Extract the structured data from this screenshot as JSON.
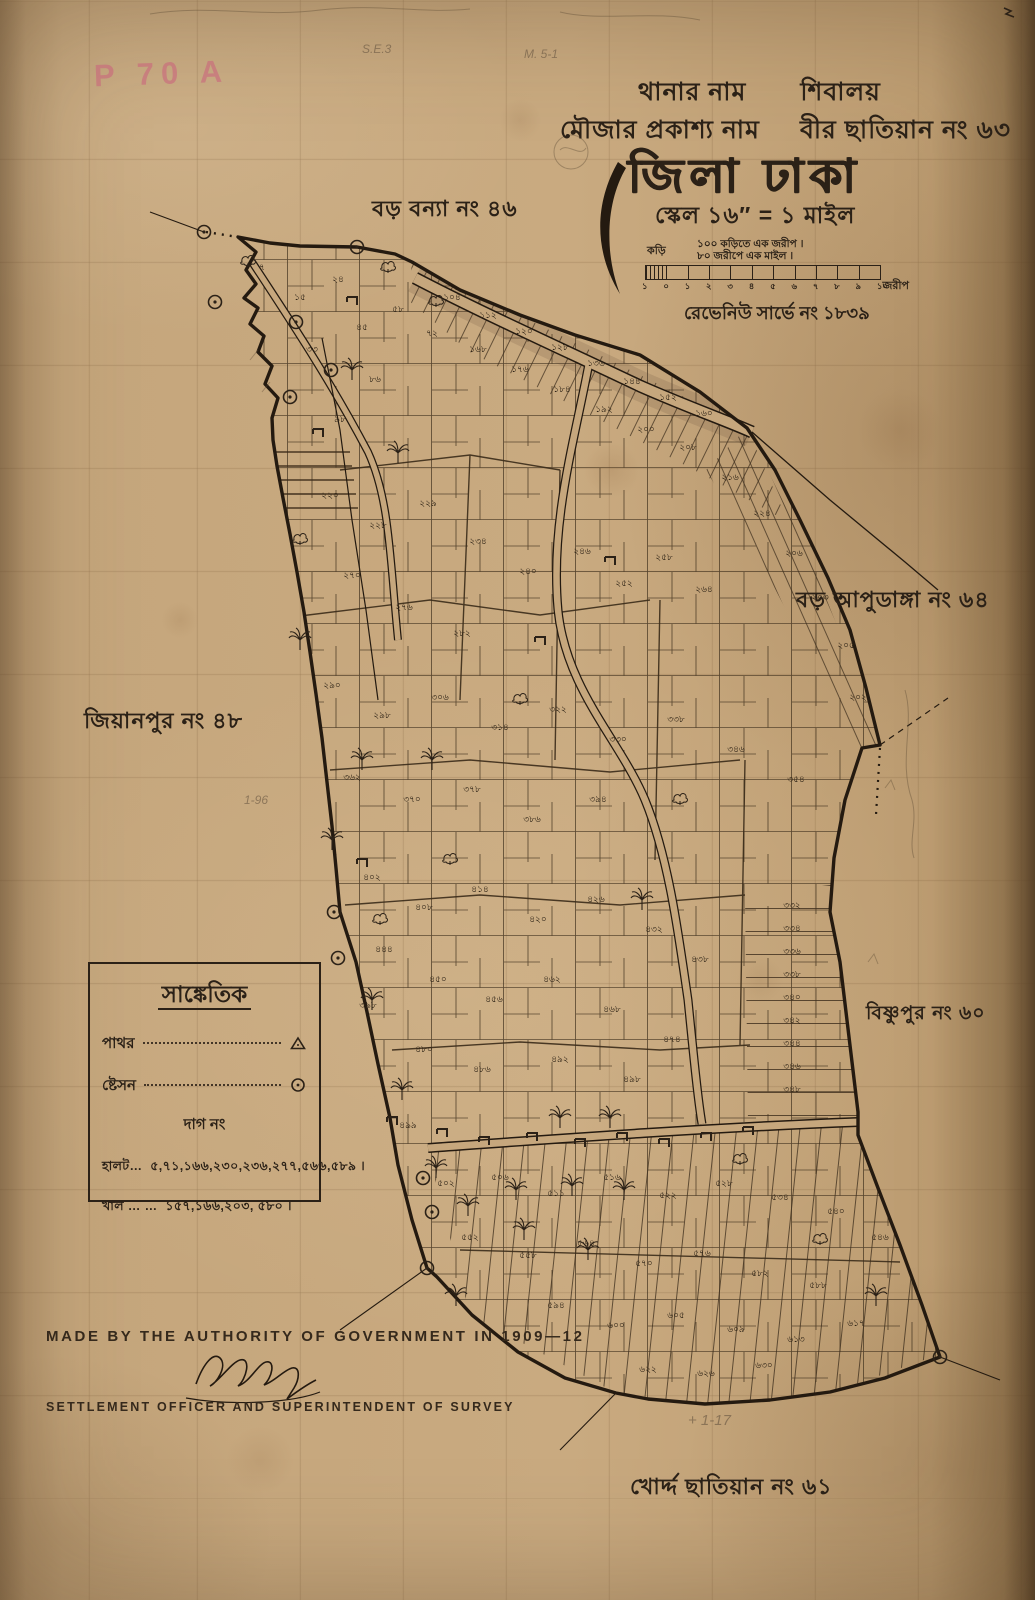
{
  "stamp": "P 70 A",
  "pencil": {
    "note1": "S.E.3",
    "note2": "M. 5-1",
    "note3": "+ 1-17",
    "note4": "1-96"
  },
  "header": {
    "thana_label": "থানার নাম",
    "thana_value": "শিবালয়",
    "mouza_label": "মৌজার প্রকাশ্য নাম",
    "mouza_value": "বীর ছাতিয়ান নং ৬৩",
    "district_title": "জিলা ঢাকা",
    "scale_line": "স্কেল ১৬″ = ১ মাইল",
    "scale_unit_left": "কড়ি",
    "scale_note_1": "১০০ কড়িতে এক জরীপ ।",
    "scale_note_2": "৮০ জরীপে এক মাইল ।",
    "scale_ticks": [
      "১",
      "০",
      "১",
      "২",
      "৩",
      "৪",
      "৫",
      "৬",
      "৭",
      "৮",
      "৯",
      "১০"
    ],
    "scale_unit_right": "জরীপ",
    "revenue_line": "রেভেনিউ সার্ভে নং ১৮৩৯"
  },
  "neighbors": [
    {
      "name": "বড় বন্যা নং ৪৬"
    },
    {
      "name": "বড় আপুডাঙ্গা নং ৬৪"
    },
    {
      "name": "জিয়ানপুর নং ৪৮"
    },
    {
      "name": "বিষ্ণুপুর নং ৬০"
    },
    {
      "name": "খোর্দ্দ ছাতিয়ান নং ৬১"
    }
  ],
  "legend": {
    "title": "সাঙ্কেতিক",
    "row_stone": "পাথর",
    "row_station": "ষ্টেসন",
    "dag_heading": "দাগ নং",
    "halot_label": "হালট…",
    "halot_numbers": "৫,৭১,১৬৬,২৩০,২৩৬,২৭৭,৫৬৬,৫৮৯ ।",
    "khal_label": "খাল … …",
    "khal_numbers": "১৫৭,১৬৬,২০৩, ৫৮০ ।"
  },
  "footer": {
    "authority_line": "MADE BY THE AUTHORITY OF GOVERNMENT IN 1909—12",
    "officer_line": "SETTLEMENT OFFICER AND SUPERINTENDENT OF SURVEY"
  },
  "map": {
    "plot_numbers": [
      [
        262,
        270,
        "৭"
      ],
      [
        300,
        300,
        "১৫"
      ],
      [
        338,
        282,
        "২৪"
      ],
      [
        312,
        352,
        "৩৩"
      ],
      [
        362,
        330,
        "৪৫"
      ],
      [
        398,
        312,
        "৫৮"
      ],
      [
        432,
        336,
        "৭২"
      ],
      [
        375,
        382,
        "৮৬"
      ],
      [
        340,
        422,
        "৯৮"
      ],
      [
        452,
        300,
        "১০৪"
      ],
      [
        488,
        318,
        "১১২"
      ],
      [
        524,
        334,
        "১২০"
      ],
      [
        560,
        350,
        "১২৮"
      ],
      [
        596,
        366,
        "১৩৬"
      ],
      [
        632,
        384,
        "১৪৪"
      ],
      [
        668,
        400,
        "১৫২"
      ],
      [
        704,
        416,
        "১৬০"
      ],
      [
        478,
        352,
        "১৬৮"
      ],
      [
        520,
        372,
        "১৭৬"
      ],
      [
        562,
        392,
        "১৮৪"
      ],
      [
        604,
        412,
        "১৯২"
      ],
      [
        646,
        432,
        "২০০"
      ],
      [
        688,
        450,
        "২০৮"
      ],
      [
        730,
        480,
        "২১৬"
      ],
      [
        762,
        516,
        "২২৪"
      ],
      [
        794,
        556,
        "২০৬"
      ],
      [
        820,
        600,
        "২০৩"
      ],
      [
        846,
        648,
        "২০৫"
      ],
      [
        858,
        700,
        "২০২"
      ],
      [
        330,
        498,
        "২২০"
      ],
      [
        378,
        528,
        "২২৮"
      ],
      [
        428,
        506,
        "২২৯"
      ],
      [
        478,
        544,
        "২৩৪"
      ],
      [
        528,
        574,
        "২৪০"
      ],
      [
        582,
        554,
        "২৪৬"
      ],
      [
        624,
        586,
        "২৫২"
      ],
      [
        664,
        560,
        "২৫৮"
      ],
      [
        704,
        592,
        "২৬৪"
      ],
      [
        352,
        578,
        "২৭০"
      ],
      [
        404,
        610,
        "২৭৬"
      ],
      [
        462,
        636,
        "২৮২"
      ],
      [
        332,
        688,
        "২৯০"
      ],
      [
        382,
        718,
        "২৯৮"
      ],
      [
        440,
        700,
        "৩০৬"
      ],
      [
        500,
        730,
        "৩১৪"
      ],
      [
        558,
        712,
        "৩২২"
      ],
      [
        618,
        742,
        "৩৩০"
      ],
      [
        676,
        722,
        "৩৩৮"
      ],
      [
        736,
        752,
        "৩৪৬"
      ],
      [
        796,
        782,
        "৩৫৪"
      ],
      [
        352,
        780,
        "৩৬২"
      ],
      [
        412,
        802,
        "৩৭০"
      ],
      [
        472,
        792,
        "৩৭৮"
      ],
      [
        532,
        822,
        "৩৮৬"
      ],
      [
        598,
        802,
        "৩৯৪"
      ],
      [
        792,
        908,
        "৩৩২"
      ],
      [
        792,
        931,
        "৩৩৪"
      ],
      [
        792,
        954,
        "৩৩৬"
      ],
      [
        792,
        977,
        "৩৩৮"
      ],
      [
        792,
        1000,
        "৩৪০"
      ],
      [
        792,
        1023,
        "৩৪২"
      ],
      [
        792,
        1046,
        "৩৪৪"
      ],
      [
        792,
        1069,
        "৩৪৬"
      ],
      [
        792,
        1092,
        "৩৪৮"
      ],
      [
        372,
        880,
        "৪০২"
      ],
      [
        424,
        910,
        "৪০৮"
      ],
      [
        480,
        892,
        "৪১৪"
      ],
      [
        538,
        922,
        "৪২০"
      ],
      [
        596,
        902,
        "৪২৬"
      ],
      [
        654,
        932,
        "৪৩২"
      ],
      [
        700,
        962,
        "৪৩৮"
      ],
      [
        384,
        952,
        "৪৪৪"
      ],
      [
        438,
        982,
        "৪৫০"
      ],
      [
        494,
        1002,
        "৪৫৬"
      ],
      [
        552,
        982,
        "৪৬২"
      ],
      [
        612,
        1012,
        "৪৬৮"
      ],
      [
        368,
        1008,
        "৩৯৮"
      ],
      [
        672,
        1042,
        "৪৭৪"
      ],
      [
        424,
        1052,
        "৪৮০"
      ],
      [
        482,
        1072,
        "৪৮৬"
      ],
      [
        560,
        1062,
        "৪৯২"
      ],
      [
        632,
        1082,
        "৪৯৮"
      ],
      [
        408,
        1128,
        "৪৯৯"
      ],
      [
        446,
        1186,
        "৫০২"
      ],
      [
        500,
        1180,
        "৫০৬"
      ],
      [
        556,
        1196,
        "৫১১"
      ],
      [
        612,
        1180,
        "৫১৬"
      ],
      [
        668,
        1198,
        "৫২২"
      ],
      [
        724,
        1186,
        "৫২৮"
      ],
      [
        780,
        1200,
        "৫৩৪"
      ],
      [
        836,
        1214,
        "৫৪০"
      ],
      [
        880,
        1240,
        "৫৪৬"
      ],
      [
        470,
        1240,
        "৫৫২"
      ],
      [
        528,
        1258,
        "৫৫৮"
      ],
      [
        586,
        1246,
        "৫৬৪"
      ],
      [
        644,
        1266,
        "৫৭০"
      ],
      [
        702,
        1256,
        "৫৭৬"
      ],
      [
        760,
        1276,
        "৫৮২"
      ],
      [
        818,
        1288,
        "৫৮৮"
      ],
      [
        556,
        1308,
        "৫৯৪"
      ],
      [
        616,
        1328,
        "৬০০"
      ],
      [
        676,
        1318,
        "৬০৫"
      ],
      [
        736,
        1332,
        "৬০৯"
      ],
      [
        796,
        1342,
        "৬১৩"
      ],
      [
        856,
        1326,
        "৬১৭"
      ],
      [
        648,
        1372,
        "৬২২"
      ],
      [
        706,
        1376,
        "৬২৬"
      ],
      [
        764,
        1368,
        "৬৩০"
      ]
    ],
    "stations": [
      [
        204,
        232
      ],
      [
        357,
        247
      ],
      [
        215,
        302
      ],
      [
        296,
        322
      ],
      [
        331,
        370
      ],
      [
        290,
        397
      ],
      [
        334,
        912
      ],
      [
        338,
        958
      ],
      [
        423,
        1178
      ],
      [
        432,
        1212
      ],
      [
        427,
        1268
      ],
      [
        940,
        1357
      ]
    ],
    "trees": [
      [
        352,
        372,
        "p"
      ],
      [
        398,
        455,
        "p"
      ],
      [
        300,
        642,
        "p"
      ],
      [
        362,
        762,
        "p"
      ],
      [
        332,
        842,
        "p"
      ],
      [
        372,
        1002,
        "p"
      ],
      [
        402,
        1092,
        "p"
      ],
      [
        436,
        1170,
        "p"
      ],
      [
        468,
        1208,
        "p"
      ],
      [
        516,
        1192,
        "p"
      ],
      [
        572,
        1188,
        "p"
      ],
      [
        624,
        1192,
        "p"
      ],
      [
        524,
        1232,
        "p"
      ],
      [
        588,
        1252,
        "p"
      ],
      [
        456,
        1298,
        "p"
      ],
      [
        876,
        1298,
        "p"
      ],
      [
        642,
        902,
        "p"
      ],
      [
        432,
        762,
        "p"
      ],
      [
        560,
        1120,
        "p"
      ],
      [
        610,
        1120,
        "p"
      ],
      [
        248,
        262,
        "b"
      ],
      [
        388,
        268,
        "b"
      ],
      [
        436,
        302,
        "b"
      ],
      [
        300,
        540,
        "b"
      ],
      [
        520,
        700,
        "b"
      ],
      [
        680,
        800,
        "b"
      ],
      [
        740,
        1160,
        "b"
      ],
      [
        820,
        1240,
        "b"
      ],
      [
        380,
        920,
        "b"
      ],
      [
        450,
        860,
        "b"
      ]
    ],
    "huts": [
      [
        442,
        1132
      ],
      [
        484,
        1140
      ],
      [
        532,
        1136
      ],
      [
        580,
        1142
      ],
      [
        622,
        1136
      ],
      [
        664,
        1142
      ],
      [
        706,
        1136
      ],
      [
        748,
        1130
      ],
      [
        362,
        862
      ],
      [
        392,
        1120
      ],
      [
        318,
        432
      ],
      [
        352,
        300
      ],
      [
        540,
        640
      ],
      [
        610,
        560
      ]
    ]
  }
}
